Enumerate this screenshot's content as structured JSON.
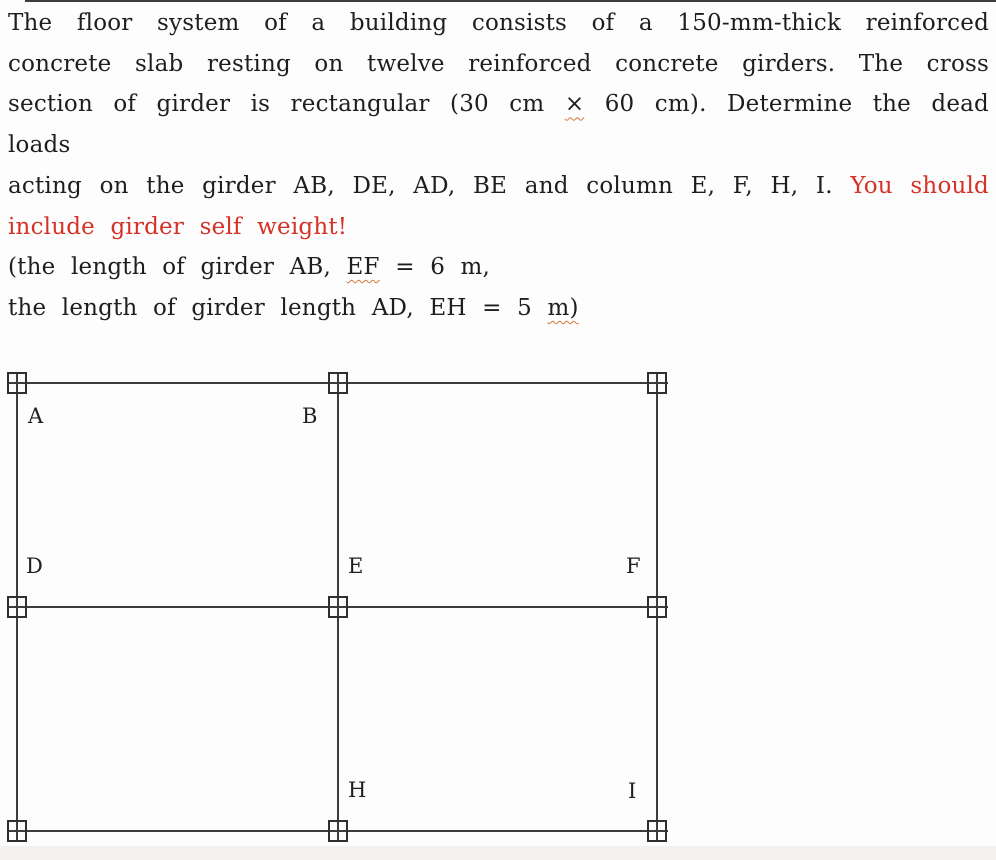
{
  "colors": {
    "text": "#1e1e1e",
    "accent_red": "#d53227",
    "spellcheck_underline": "#d4763a",
    "diagram_line": "#3c3c3c",
    "bottom_strip": "#f2f1ee"
  },
  "problem": {
    "line1": "The floor system of a building consists of a 150-mm-thick reinforced",
    "line2": "concrete slab resting on twelve reinforced concrete girders. The cross",
    "line3_a": "section of girder is rectangular (30 cm",
    "line3_times": "×",
    "line3_b": "60 cm). Determine the dead loads",
    "line4_a": "acting on the girder AB, DE, AD, BE and column E, F, H, I.",
    "line4_red": "You should",
    "line5_red": "include girder self weight!",
    "line6_a": "(the length of girder AB,",
    "line6_ef": "EF",
    "line6_b": "= 6 m,",
    "line7_a": "the length of girder length AD, EH = 5",
    "line7_m": "m)"
  },
  "diagram": {
    "description": "Plan view of floor framing: 3x3 column grid (9 column markers) forming 2x2 bays of girders",
    "labels": {
      "A": "A",
      "B": "B",
      "D": "D",
      "E": "E",
      "F": "F",
      "H": "H",
      "I": "I"
    }
  }
}
